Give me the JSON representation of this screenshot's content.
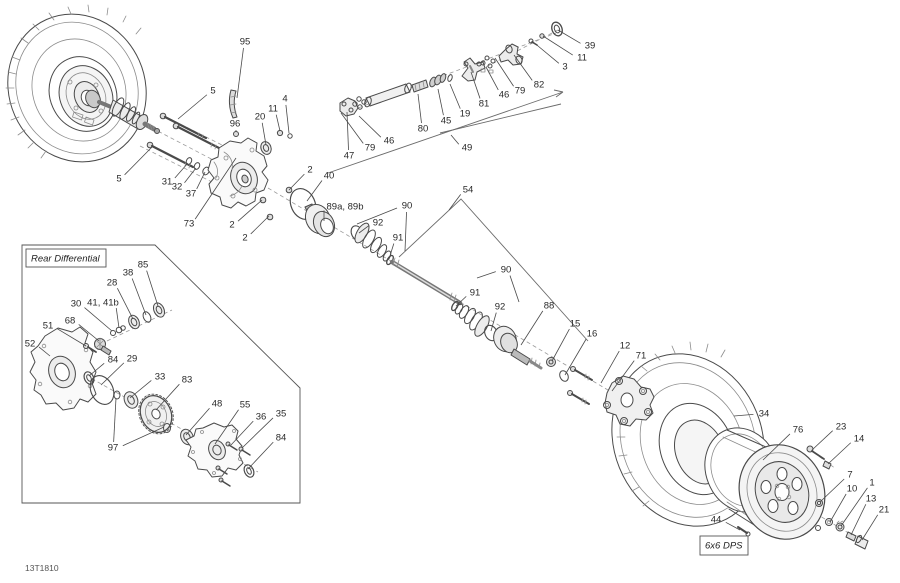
{
  "diagram": {
    "code": "13T1810",
    "colors": {
      "background": "#ffffff",
      "line": "#4a4a4a",
      "label": "#2a2a2a"
    },
    "boxed_labels": [
      {
        "id": "rear-differential",
        "text": "Rear Differential"
      },
      {
        "id": "model-variant",
        "text": "6x6 DPS"
      }
    ],
    "callouts": [
      {
        "label": "95",
        "x": 245,
        "y": 42,
        "targets": [
          [
            237,
            98
          ]
        ]
      },
      {
        "label": "5",
        "x": 213,
        "y": 91,
        "targets": [
          [
            178,
            119
          ]
        ]
      },
      {
        "label": "4",
        "x": 285,
        "y": 99,
        "targets": [
          [
            289,
            133
          ]
        ]
      },
      {
        "label": "11",
        "x": 273,
        "y": 109,
        "targets": [
          [
            280,
            131
          ]
        ]
      },
      {
        "label": "20",
        "x": 260,
        "y": 117,
        "targets": [
          [
            266,
            145
          ]
        ]
      },
      {
        "label": "96",
        "x": 235,
        "y": 124,
        "targets": [
          [
            236,
            132
          ]
        ]
      },
      {
        "label": "5",
        "x": 119,
        "y": 179,
        "targets": [
          [
            152,
            147
          ]
        ]
      },
      {
        "label": "31",
        "x": 167,
        "y": 182,
        "targets": [
          [
            188,
            163
          ]
        ]
      },
      {
        "label": "32",
        "x": 177,
        "y": 187,
        "targets": [
          [
            196,
            168
          ]
        ]
      },
      {
        "label": "37",
        "x": 191,
        "y": 194,
        "targets": [
          [
            205,
            172
          ]
        ]
      },
      {
        "label": "73",
        "x": 189,
        "y": 224,
        "targets": [
          [
            236,
            158
          ]
        ]
      },
      {
        "label": "2",
        "x": 310,
        "y": 170,
        "targets": [
          [
            289,
            190
          ]
        ]
      },
      {
        "label": "2",
        "x": 232,
        "y": 225,
        "targets": [
          [
            262,
            200
          ]
        ]
      },
      {
        "label": "2",
        "x": 245,
        "y": 238,
        "targets": [
          [
            269,
            216
          ]
        ]
      },
      {
        "label": "40",
        "x": 329,
        "y": 176,
        "targets": [
          [
            307,
            201
          ]
        ]
      },
      {
        "label": "47",
        "x": 349,
        "y": 156,
        "targets": [
          [
            347,
            112
          ]
        ]
      },
      {
        "label": "79",
        "x": 370,
        "y": 148,
        "targets": [
          [
            341,
            113
          ]
        ]
      },
      {
        "label": "46",
        "x": 389,
        "y": 141,
        "targets": [
          [
            359,
            116
          ]
        ]
      },
      {
        "label": "80",
        "x": 423,
        "y": 129,
        "targets": [
          [
            418,
            94
          ]
        ]
      },
      {
        "label": "45",
        "x": 446,
        "y": 121,
        "targets": [
          [
            438,
            89
          ]
        ]
      },
      {
        "label": "19",
        "x": 465,
        "y": 114,
        "targets": [
          [
            450,
            84
          ]
        ]
      },
      {
        "label": "81",
        "x": 484,
        "y": 104,
        "targets": [
          [
            471,
            72
          ]
        ]
      },
      {
        "label": "46",
        "x": 504,
        "y": 95,
        "targets": [
          [
            486,
            67
          ]
        ]
      },
      {
        "label": "79",
        "x": 520,
        "y": 91,
        "targets": [
          [
            495,
            58
          ]
        ]
      },
      {
        "label": "82",
        "x": 539,
        "y": 85,
        "targets": [
          [
            514,
            55
          ]
        ]
      },
      {
        "label": "3",
        "x": 565,
        "y": 67,
        "targets": [
          [
            532,
            41
          ]
        ]
      },
      {
        "label": "11",
        "x": 582,
        "y": 58,
        "targets": [
          [
            543,
            36
          ]
        ]
      },
      {
        "label": "39",
        "x": 590,
        "y": 46,
        "targets": [
          [
            558,
            30
          ]
        ]
      },
      {
        "label": "49",
        "x": 467,
        "y": 148,
        "targets": [
          [
            451,
            135
          ]
        ]
      },
      {
        "label": "54",
        "x": 468,
        "y": 190,
        "targets": [
          [
            449,
            210
          ]
        ]
      },
      {
        "label": "89a, 89b",
        "x": 345,
        "y": 207,
        "targets": [
          [
            324,
            221
          ]
        ]
      },
      {
        "label": "92",
        "x": 378,
        "y": 223,
        "targets": [
          [
            359,
            233
          ]
        ]
      },
      {
        "label": "90",
        "x": 407,
        "y": 206,
        "targets": [
          [
            357,
            224
          ],
          [
            405,
            251
          ]
        ]
      },
      {
        "label": "91",
        "x": 398,
        "y": 238,
        "targets": [
          [
            389,
            259
          ]
        ]
      },
      {
        "label": "90",
        "x": 506,
        "y": 270,
        "targets": [
          [
            477,
            278
          ],
          [
            519,
            302
          ]
        ]
      },
      {
        "label": "91",
        "x": 475,
        "y": 293,
        "targets": [
          [
            456,
            306
          ]
        ]
      },
      {
        "label": "92",
        "x": 500,
        "y": 307,
        "targets": [
          [
            491,
            331
          ]
        ]
      },
      {
        "label": "88",
        "x": 549,
        "y": 306,
        "targets": [
          [
            521,
            345
          ]
        ]
      },
      {
        "label": "15",
        "x": 575,
        "y": 324,
        "targets": [
          [
            552,
            361
          ]
        ]
      },
      {
        "label": "16",
        "x": 592,
        "y": 334,
        "targets": [
          [
            565,
            375
          ]
        ]
      },
      {
        "label": "12",
        "x": 625,
        "y": 346,
        "targets": [
          [
            601,
            383
          ]
        ]
      },
      {
        "label": "71",
        "x": 641,
        "y": 356,
        "targets": [
          [
            612,
            391
          ]
        ]
      },
      {
        "label": "34",
        "x": 764,
        "y": 414,
        "targets": [
          [
            734,
            416
          ]
        ]
      },
      {
        "label": "76",
        "x": 798,
        "y": 430,
        "targets": [
          [
            763,
            460
          ]
        ]
      },
      {
        "label": "23",
        "x": 841,
        "y": 427,
        "targets": [
          [
            812,
            450
          ]
        ]
      },
      {
        "label": "14",
        "x": 859,
        "y": 439,
        "targets": [
          [
            828,
            464
          ]
        ]
      },
      {
        "label": "7",
        "x": 850,
        "y": 475,
        "targets": [
          [
            820,
            502
          ]
        ]
      },
      {
        "label": "10",
        "x": 852,
        "y": 489,
        "targets": [
          [
            830,
            522
          ]
        ]
      },
      {
        "label": "1",
        "x": 872,
        "y": 483,
        "targets": [
          [
            841,
            526
          ]
        ]
      },
      {
        "label": "13",
        "x": 871,
        "y": 499,
        "targets": [
          [
            851,
            535
          ]
        ]
      },
      {
        "label": "21",
        "x": 884,
        "y": 510,
        "targets": [
          [
            862,
            540
          ]
        ]
      },
      {
        "label": "44",
        "x": 716,
        "y": 520,
        "targets": [
          [
            740,
            530
          ]
        ]
      },
      {
        "label": "85",
        "x": 143,
        "y": 265,
        "targets": [
          [
            158,
            306
          ]
        ]
      },
      {
        "label": "38",
        "x": 128,
        "y": 273,
        "targets": [
          [
            146,
            315
          ]
        ]
      },
      {
        "label": "28",
        "x": 112,
        "y": 283,
        "targets": [
          [
            133,
            319
          ]
        ]
      },
      {
        "label": "41, 41b",
        "x": 103,
        "y": 303,
        "targets": [
          [
            119,
            328
          ]
        ]
      },
      {
        "label": "30",
        "x": 76,
        "y": 304,
        "targets": [
          [
            112,
            331
          ]
        ]
      },
      {
        "label": "68",
        "x": 70,
        "y": 321,
        "targets": [
          [
            99,
            341
          ]
        ]
      },
      {
        "label": "51",
        "x": 48,
        "y": 326,
        "targets": [
          [
            86,
            346
          ]
        ]
      },
      {
        "label": "52",
        "x": 30,
        "y": 344,
        "targets": [
          [
            50,
            356
          ]
        ]
      },
      {
        "label": "84",
        "x": 113,
        "y": 360,
        "targets": [
          [
            89,
            376
          ]
        ]
      },
      {
        "label": "29",
        "x": 132,
        "y": 359,
        "targets": [
          [
            101,
            385
          ]
        ]
      },
      {
        "label": "33",
        "x": 160,
        "y": 377,
        "targets": [
          [
            130,
            398
          ]
        ]
      },
      {
        "label": "83",
        "x": 187,
        "y": 380,
        "targets": [
          [
            156,
            410
          ]
        ]
      },
      {
        "label": "97",
        "x": 113,
        "y": 448,
        "targets": [
          [
            164,
            427
          ],
          [
            116,
            398
          ]
        ]
      },
      {
        "label": "48",
        "x": 217,
        "y": 404,
        "targets": [
          [
            186,
            435
          ]
        ]
      },
      {
        "label": "55",
        "x": 245,
        "y": 405,
        "targets": [
          [
            215,
            444
          ]
        ]
      },
      {
        "label": "36",
        "x": 261,
        "y": 417,
        "targets": [
          [
            231,
            445
          ]
        ]
      },
      {
        "label": "35",
        "x": 281,
        "y": 414,
        "targets": [
          [
            242,
            448
          ]
        ]
      },
      {
        "label": "84",
        "x": 281,
        "y": 438,
        "targets": [
          [
            248,
            469
          ]
        ]
      }
    ]
  }
}
